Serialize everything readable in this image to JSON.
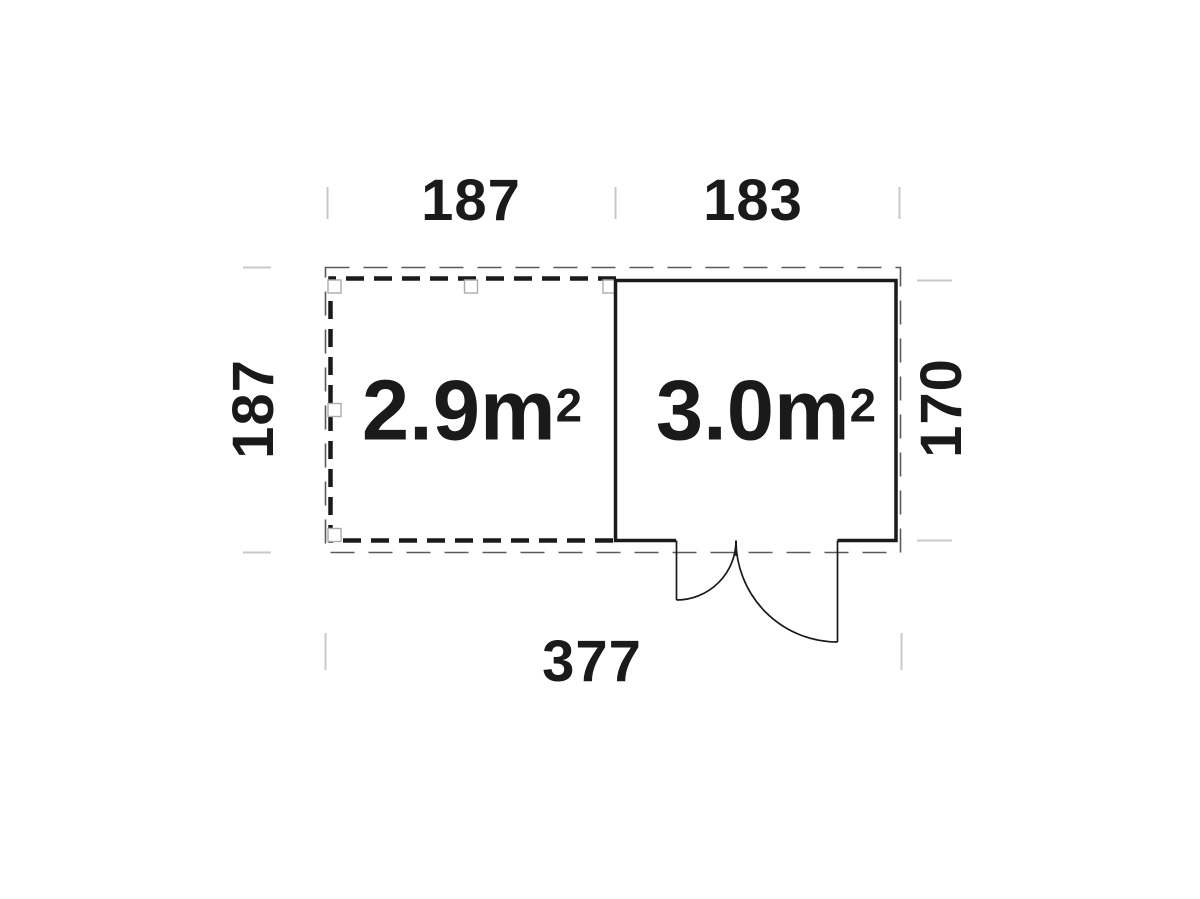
{
  "dimensions": {
    "top_terrace": "187",
    "top_cabin": "183",
    "left_overall": "187",
    "right_cabin": "170",
    "bottom_overall": "377"
  },
  "areas": {
    "terrace": {
      "base": "2.9m",
      "exponent": "2"
    },
    "cabin": {
      "base": "3.0m",
      "exponent": "2"
    }
  },
  "colors": {
    "background": "#ffffff",
    "ink": "#1a1a1a",
    "overhang_dash": "#5a5a5a",
    "post_outline": "#ababab",
    "extension_tick": "#c9c9c9"
  }
}
